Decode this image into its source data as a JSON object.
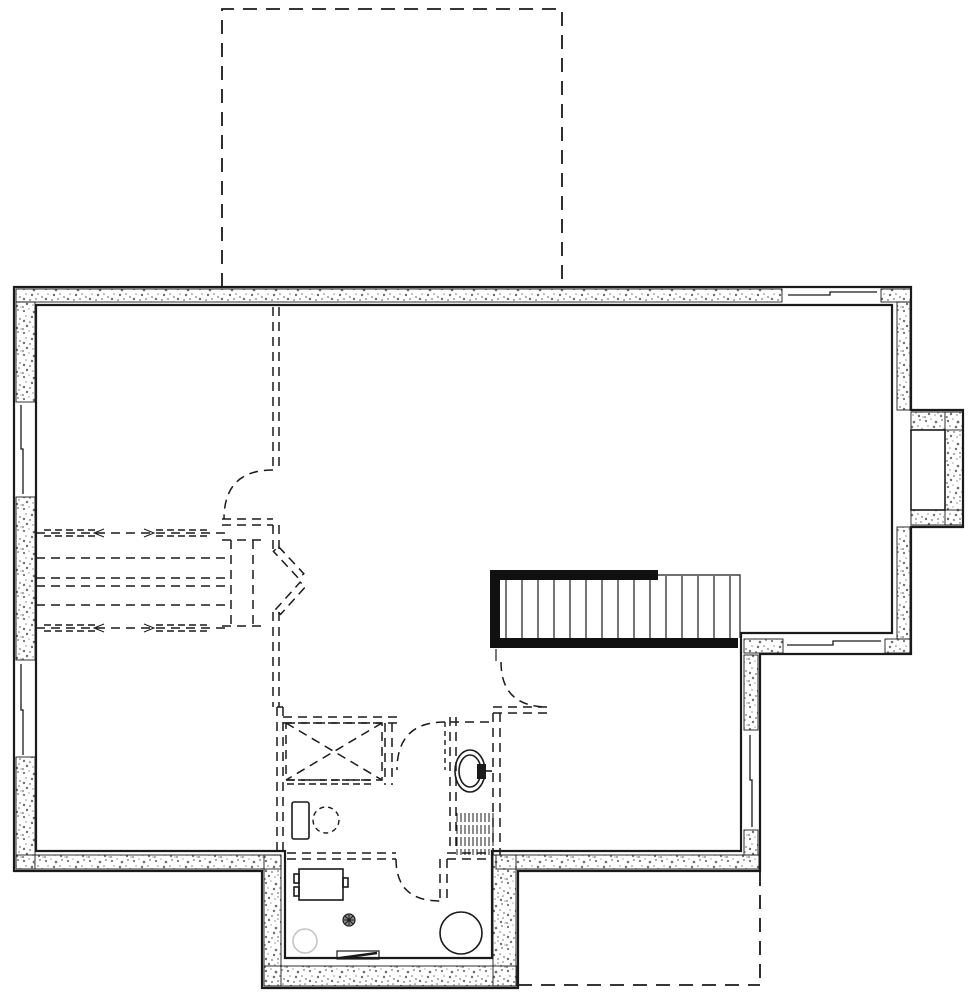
{
  "meta": {
    "content": "basement-foundation-floor-plan",
    "visible_text": "none"
  },
  "colors": {
    "background": "#ffffff",
    "wall_line": "#1a1a1a",
    "stair_fill": "#111111",
    "speck_dark": "#6f6f6f",
    "speck_light": "#a8a8a8",
    "sump_outline": "#c5c5c5",
    "drain_fill": "#8c8c8c"
  },
  "stairs": {
    "tread_count": 15
  },
  "windows": {
    "top_wall": 1,
    "left_wall": 2,
    "right_step_wall": 1,
    "right_side_wall": 1
  },
  "door_swings_dashed": 5,
  "fixtures": [
    "toilet-rough-in",
    "shower-rough-in",
    "laundry-tub",
    "washer-rough-in",
    "furnace",
    "floor-drain",
    "sump-pit",
    "water-heater",
    "floor-vent"
  ],
  "outlines_dashed": [
    "upper-floor-footprint",
    "future-partition-walls",
    "duct-runs",
    "patio-footprint"
  ]
}
